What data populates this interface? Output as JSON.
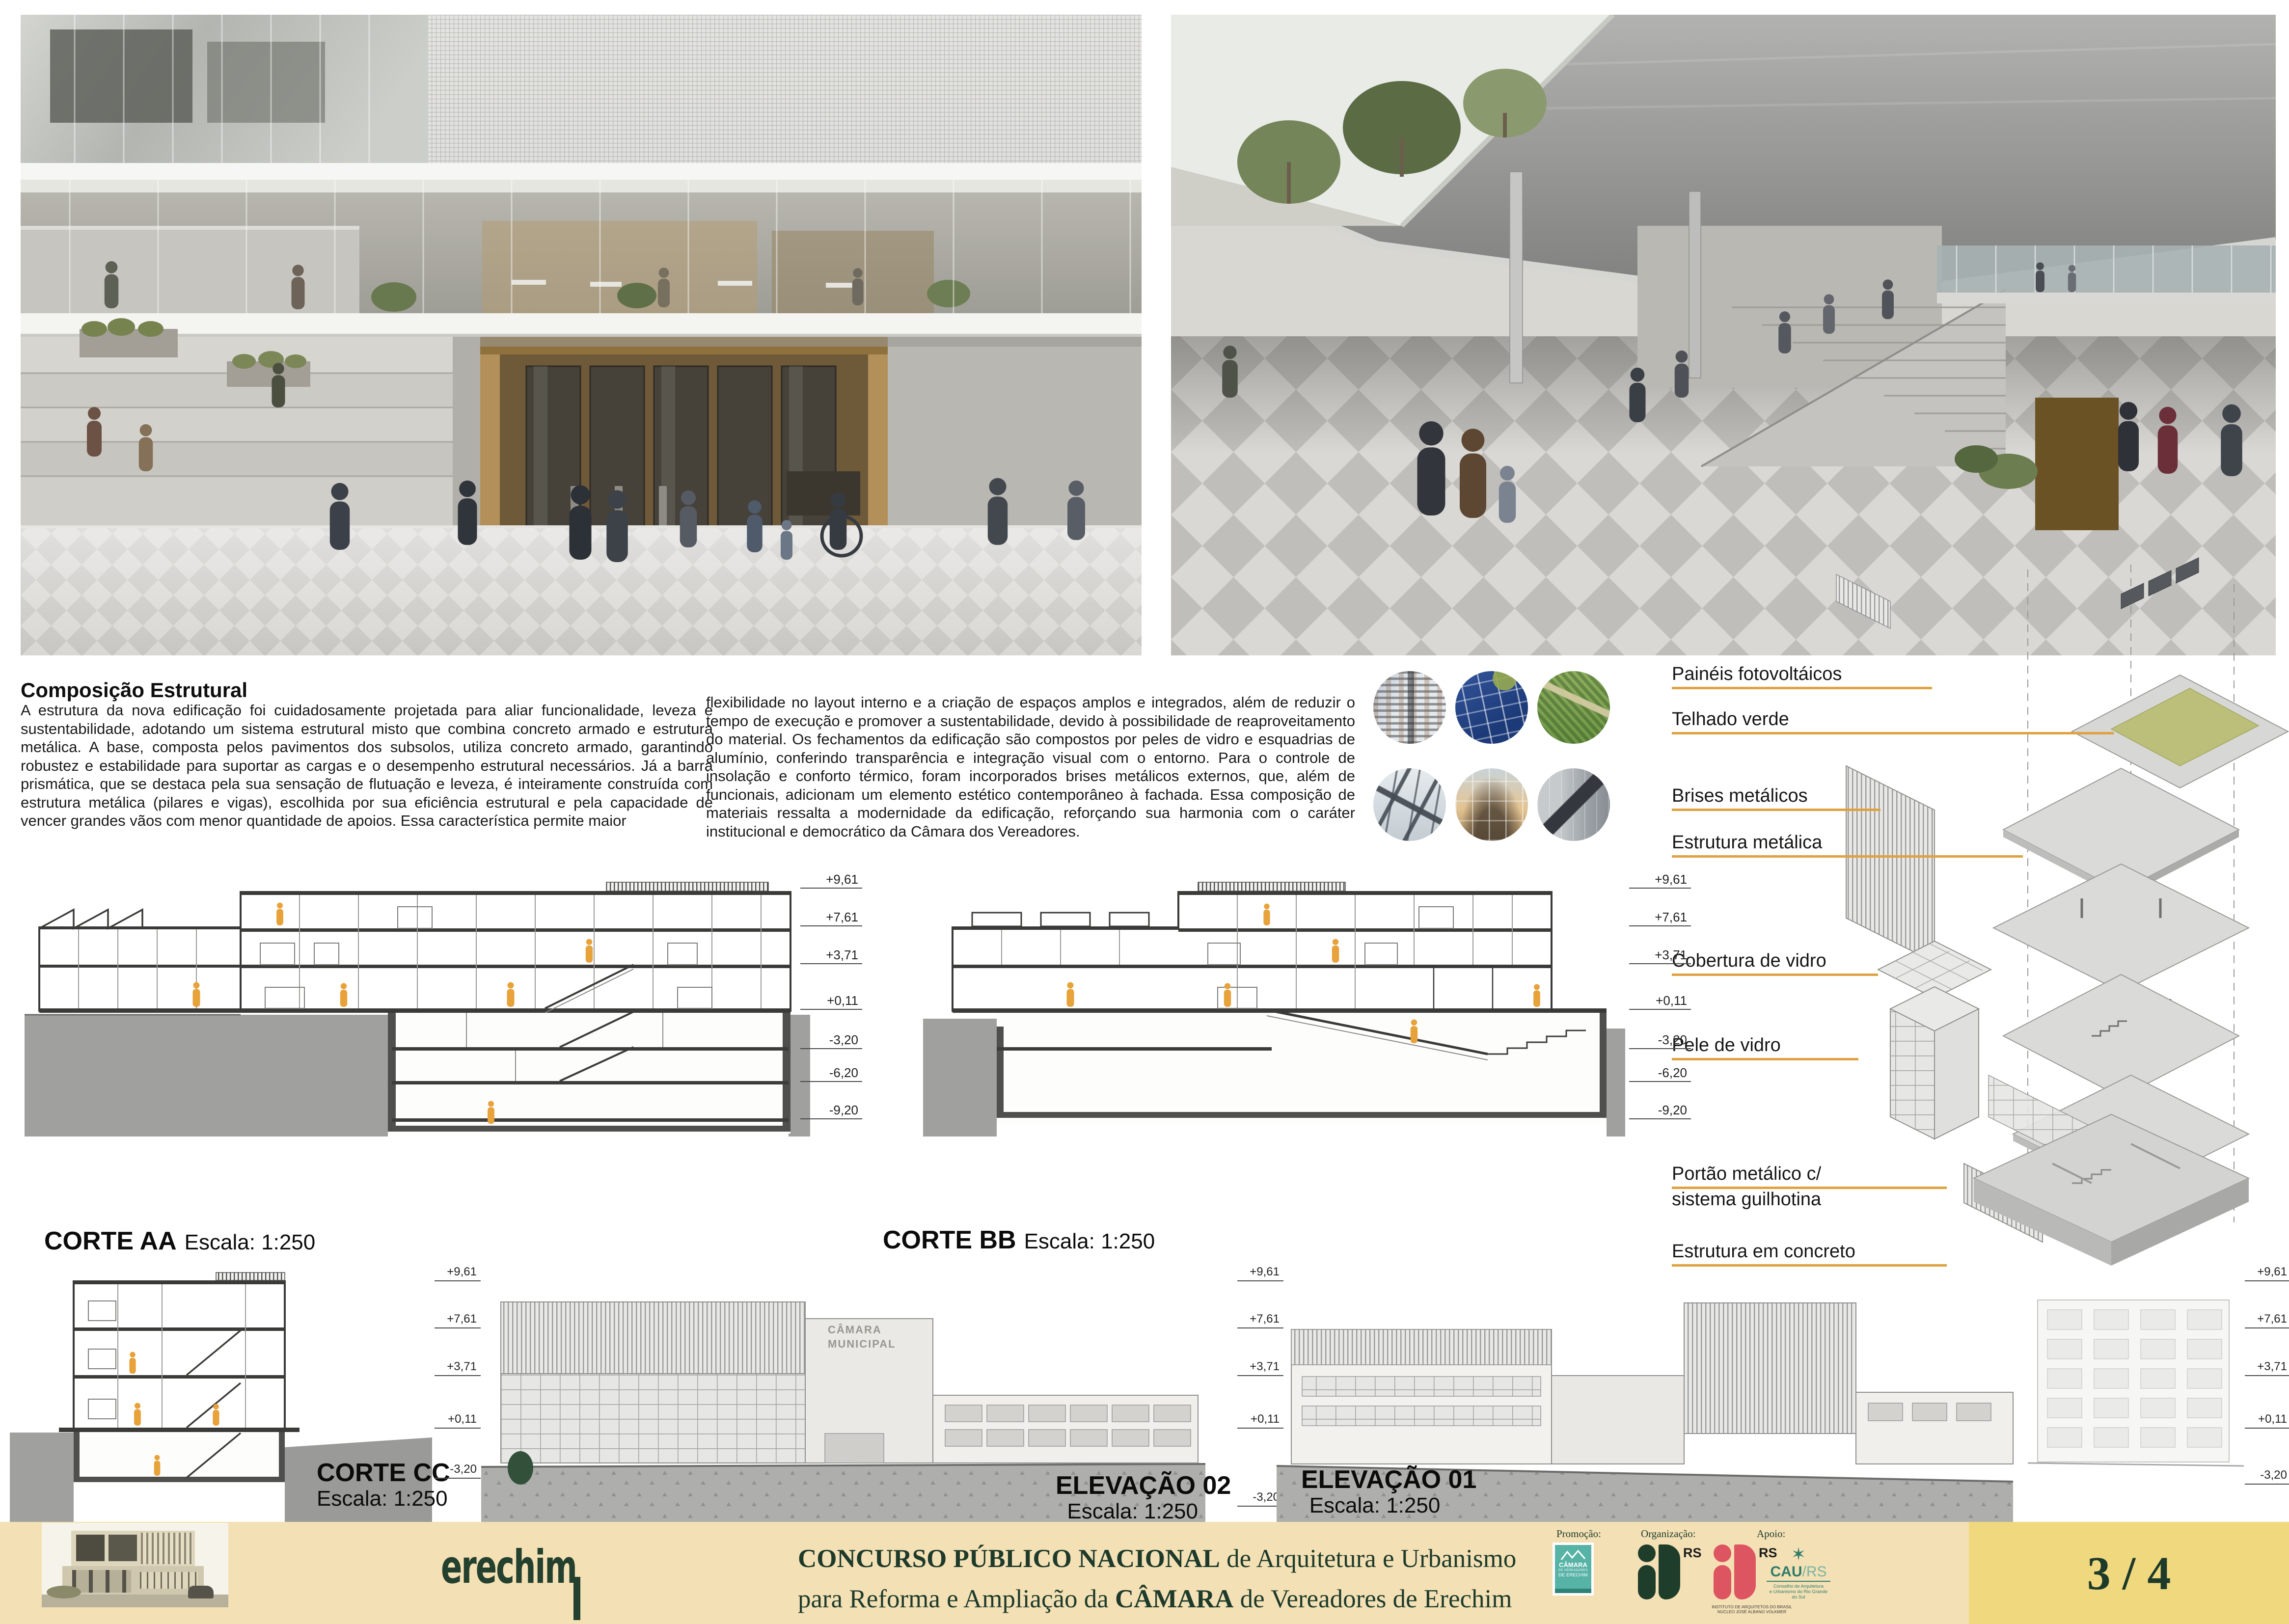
{
  "board": {
    "page_number": "3 / 4",
    "colors": {
      "leader_orange": "#dfa240",
      "footer_beige": "#f3e0b4",
      "page_box_yellow": "#f0d87e",
      "dark_green": "#1d3a2b",
      "figure_orange": "#e7a23a"
    }
  },
  "essay": {
    "heading": "Composição Estrutural",
    "col1": "A estrutura da nova edificação foi cuidadosamente projetada para aliar funcionalidade, leveza e sustentabilidade, adotando um sistema estrutural misto que combina concreto armado e estrutura metálica. A base, composta pelos pavimentos dos subsolos, utiliza concreto armado, garantindo robustez e estabilidade para suportar as cargas e o desempenho estrutural necessários. Já a barra prismática, que se destaca pela sua sensação de flutuação e leveza, é inteiramente construída com estrutura metálica (pilares e vigas), escolhida por sua eficiência estrutural e pela capacidade de vencer grandes vãos com menor quantidade de apoios. Essa característica permite maior",
    "col2": "flexibilidade no layout interno e a criação de espaços amplos e integrados, além de reduzir o tempo de execução e promover a sustentabilidade, devido à possibilidade de reaproveitamento do material. Os fechamentos da edificação são compostos por peles de vidro e esquadrias de alumínio, conferindo transparência e integração visual com o entorno. Para o controle de insolação e conforto térmico, foram incorporados brises metálicos externos, que, além de funcionais, adicionam um elemento estético contemporâneo à fachada. Essa composição de materiais ressalta a modernidade da edificação, reforçando sua harmonia com o caráter institucional e democrático da Câmara dos Vereadores."
  },
  "axon": {
    "labels": [
      "Painéis fotovoltáicos",
      "Telhado verde",
      "Brises metálicos",
      "Estrutura metálica",
      "Cobertura de vidro",
      "Pele de vidro",
      "Portão metálico c/",
      "sistema guilhotina",
      "Estrutura em concreto"
    ]
  },
  "sections": {
    "levels": [
      "+9,61",
      "+7,61",
      "+3,71",
      "+0,11",
      "-3,20",
      "-6,20",
      "-9,20"
    ],
    "levels_short": [
      "+9,61",
      "+7,61",
      "+3,71",
      "+0,11",
      "-3,20"
    ],
    "corte_aa": {
      "title": "CORTE AA",
      "scale": "Escala: 1:250"
    },
    "corte_bb": {
      "title": "CORTE BB",
      "scale": "Escala: 1:250"
    },
    "corte_cc": {
      "title": "CORTE CC",
      "scale": "Escala: 1:250"
    },
    "elevacao_02": {
      "title": "ELEVAÇÃO 02",
      "scale": "Escala: 1:250"
    },
    "elevacao_01": {
      "title": "ELEVAÇÃO 01",
      "scale": "Escala: 1:250"
    },
    "facade_sign": "CÂMARA\nMUNICIPAL"
  },
  "footer": {
    "logo_text": "erechim",
    "title": {
      "strong1": "CONCURSO PÚBLICO NACIONAL",
      "rest1": " de Arquitetura e Urbanismo",
      "pre2": "para Reforma e Ampliação da ",
      "strong2": "CÂMARA",
      "rest2": " de Vereadores de Erechim"
    },
    "sponsors": {
      "promo_label": "Promoção:",
      "org_label": "Organização:",
      "apoio_label": "Apoio:",
      "camara": {
        "l1": "CÂMARA",
        "l2": "DE VEREADORES",
        "l3": "DE ERECHIM"
      },
      "iab_green_rs": "RS",
      "iab_red_rs": "RS",
      "iab_sub": "INSTITUTO DE ARQUITETOS DO BRASIL\nNÚCLEO JOSÉ ALBANO VOLKMER",
      "cau": {
        "name": "CAU",
        "suffix": "/RS",
        "sub": "Conselho de Arquitetura\ne Urbanismo do Rio Grande do Sul"
      }
    }
  }
}
